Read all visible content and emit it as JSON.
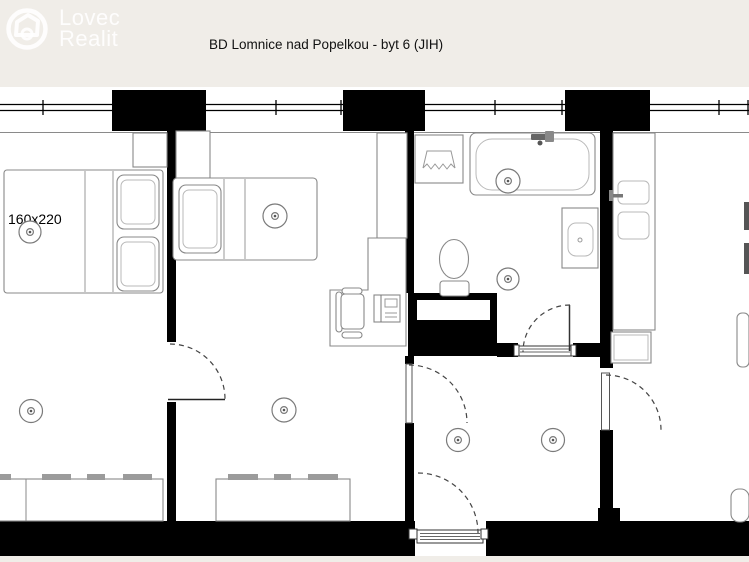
{
  "header": {
    "logo": {
      "line1": "Lovec",
      "line2": "Realit"
    },
    "title": "BD Lomnice nad Popelkou - byt 6 (JIH)"
  },
  "floorplan": {
    "bed_label": "160x220"
  },
  "colors": {
    "background": "#f0ede8",
    "plan_background": "#ffffff",
    "wall": "#000000",
    "furniture_outline": "#888888",
    "title_text": "#111111",
    "logo_watermark": "#ffffff"
  }
}
